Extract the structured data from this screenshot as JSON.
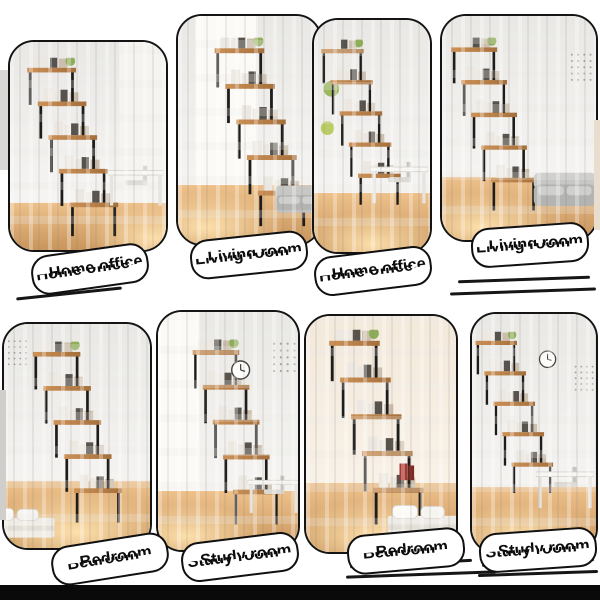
{
  "page": {
    "background_color": "#ffffff",
    "bottom_bar_color": "#0a0a0a",
    "panel_border_color": "#141414",
    "pill_background": "#ffffff",
    "pill_text_color": "#0c0c0c"
  },
  "product": {
    "item": "ladder bookshelf collage",
    "rooms_shown": [
      "Home office",
      "Living room",
      "Home office",
      "Living room",
      "Bedroom",
      "Study room",
      "Bedroom",
      "Study room"
    ]
  },
  "panels": [
    {
      "id": "top-1",
      "label": "Home office",
      "room": "home-office"
    },
    {
      "id": "top-2",
      "label": "Living room",
      "room": "living-room"
    },
    {
      "id": "top-3",
      "label": "Home office",
      "room": "home-office"
    },
    {
      "id": "top-4",
      "label": "Living room",
      "room": "living-room"
    },
    {
      "id": "bottom-1",
      "label": "Bedroom",
      "room": "bedroom"
    },
    {
      "id": "bottom-2",
      "label": "Study room",
      "room": "study-room"
    },
    {
      "id": "bottom-3",
      "label": "Bedroom",
      "room": "bedroom"
    },
    {
      "id": "bottom-4",
      "label": "Study room",
      "room": "study-room"
    }
  ],
  "scene_colors": {
    "wall": "#efeeec",
    "wall_warm": "#f5ebdf",
    "floor": "#d9a265",
    "glow": "#ffdfae",
    "shelf_frame": "#1f1d1b",
    "shelf_board": "#bd7f47"
  }
}
